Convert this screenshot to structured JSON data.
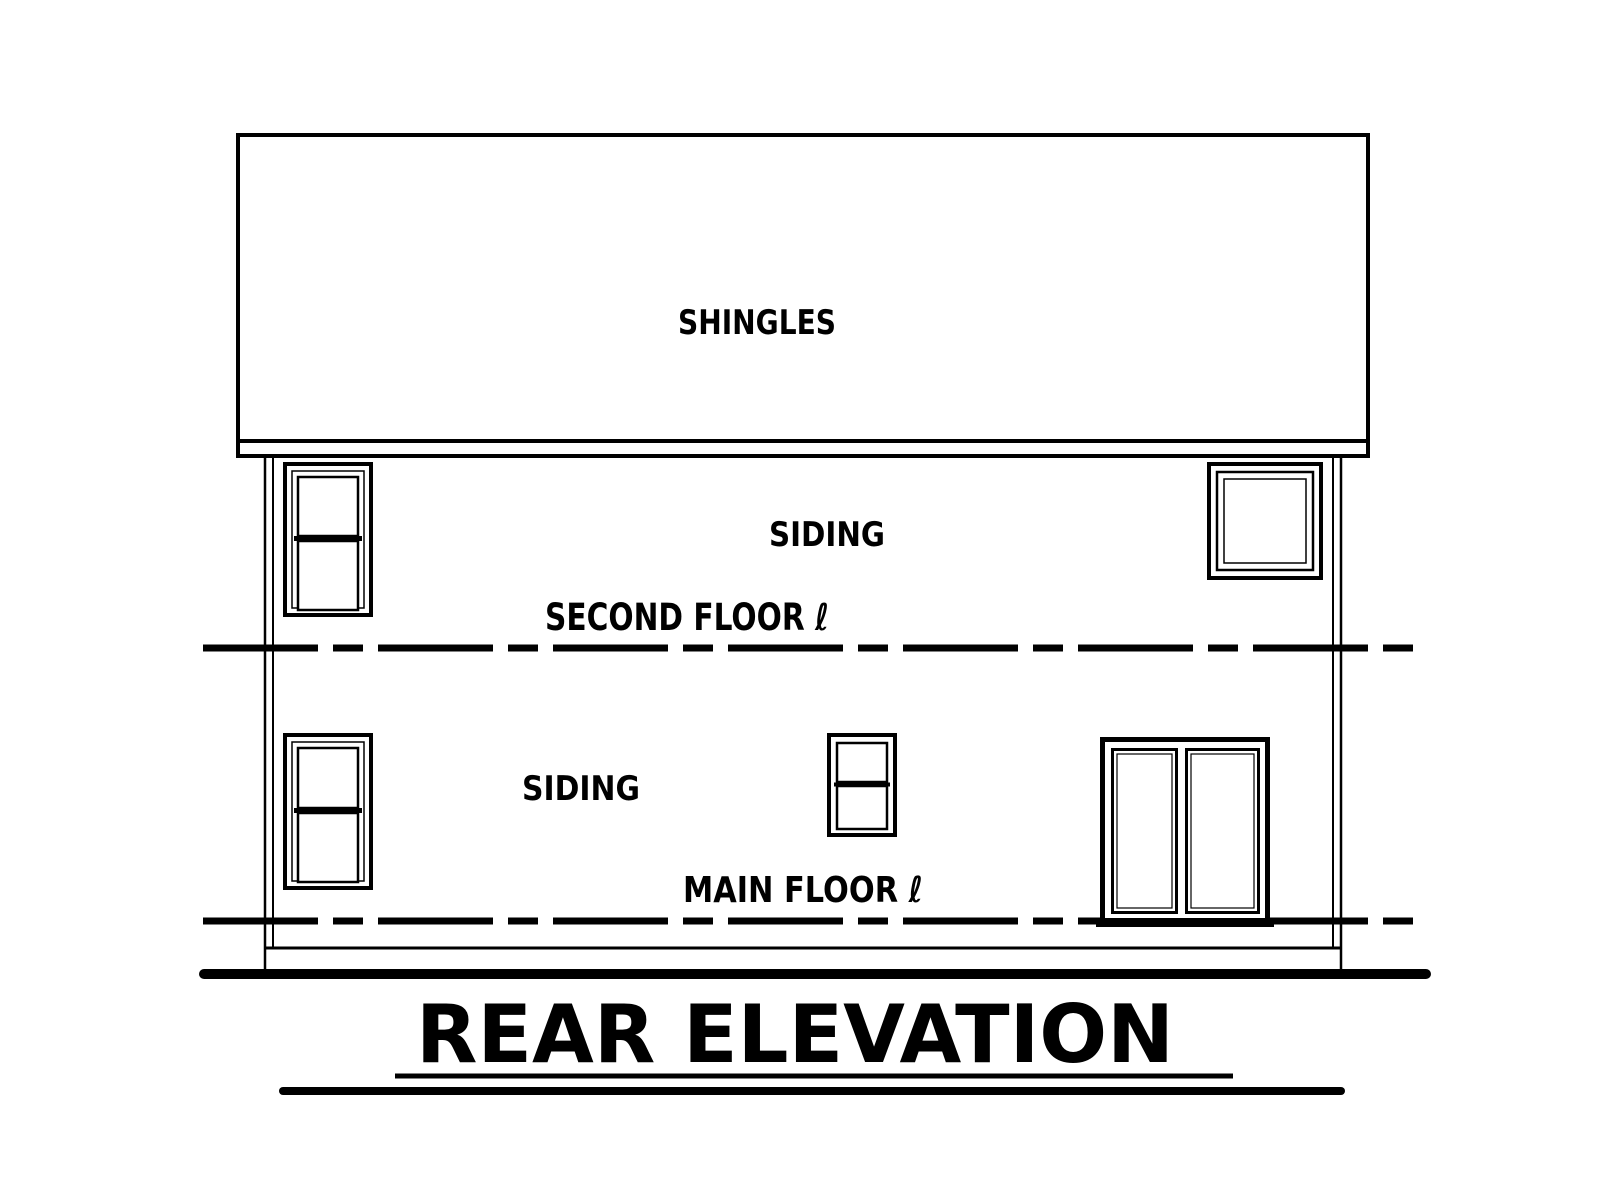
{
  "drawing": {
    "type": "architectural-rear-elevation",
    "title": "REAR ELEVATION",
    "labels": {
      "roof_material": "SHINGLES",
      "upper_wall_material": "SIDING",
      "main_wall_material": "SIDING",
      "second_floor_level": "SECOND FLOOR ℓ",
      "main_floor_level": "MAIN FLOOR ℓ"
    },
    "colors": {
      "ink": "#000000",
      "paper": "#ffffff"
    }
  }
}
